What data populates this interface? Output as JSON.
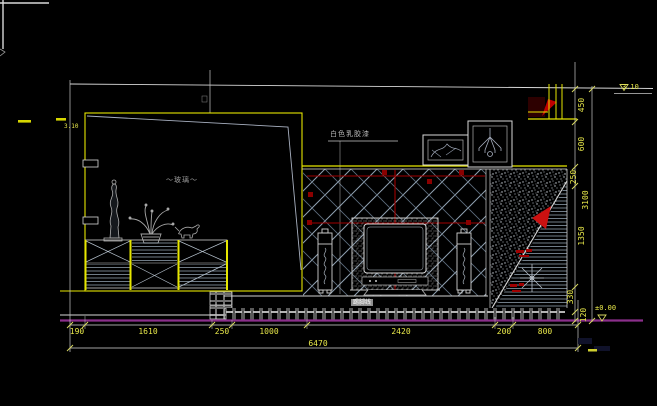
{
  "canvas": {
    "width": 657,
    "height": 406,
    "background": "#000000"
  },
  "labels": {
    "paint_finish": "白色乳胶漆",
    "bay_window": "～玻璃～",
    "skirting_chip": "踢脚线",
    "level_top": "3.10",
    "level_floor": "±0.00",
    "level_left": "3.10"
  },
  "dimensions": {
    "bottom": [
      "190",
      "1610",
      "250",
      "1000",
      "2420",
      "200",
      "800"
    ],
    "bottom_total": "6470",
    "right": [
      "450",
      "600",
      "250",
      "1350",
      "330",
      "120"
    ],
    "right_total": "3100"
  },
  "colors": {
    "dimension_text": "#e8e84a",
    "outline_yellow": "#e6e600",
    "line_white": "#d8d8d8",
    "hatch_gray": "#8fa0b0",
    "accent_red": "#cc1111",
    "dark_red": "#8b0000",
    "floor_magenta": "#8b2f8b"
  }
}
